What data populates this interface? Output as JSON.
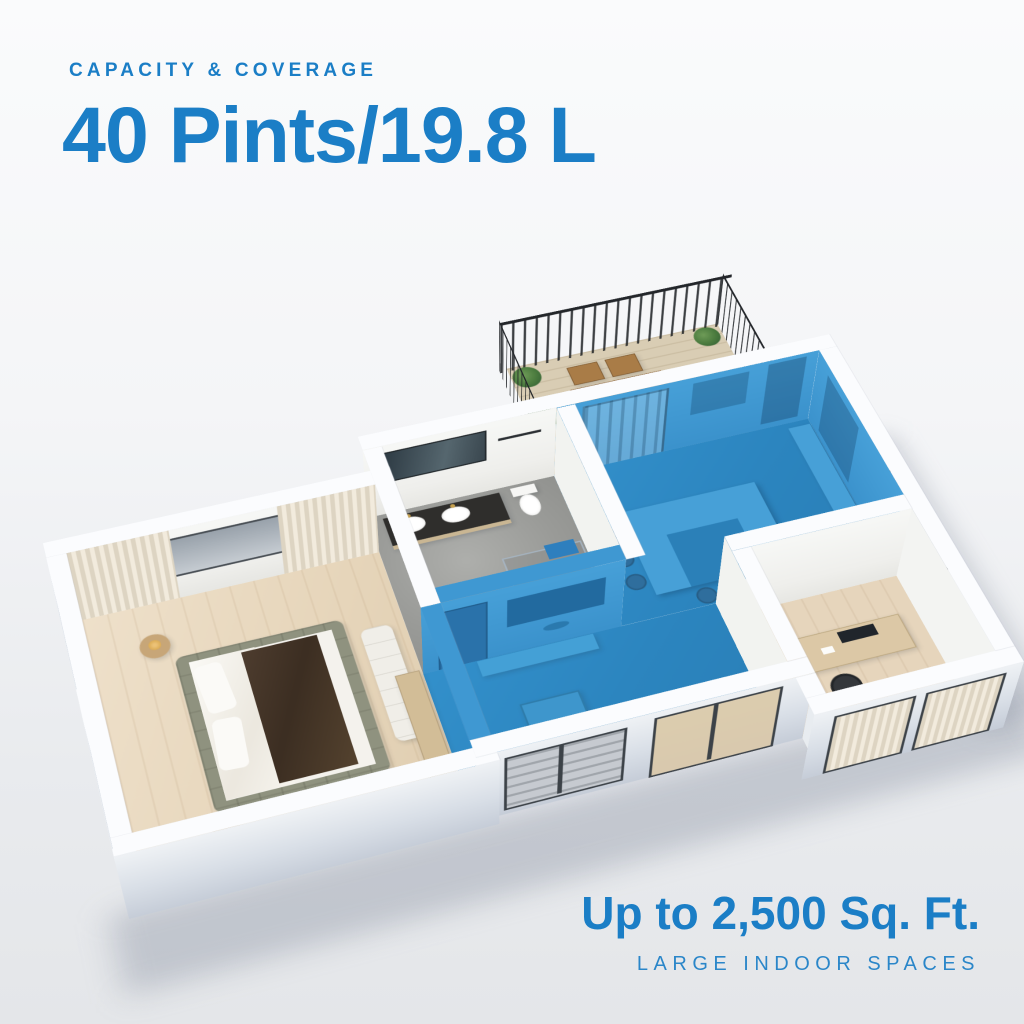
{
  "header": {
    "eyebrow": "CAPACITY & COVERAGE",
    "headline": "40 Pints/19.8 L"
  },
  "footer": {
    "coverage": "Up to 2,500 Sq. Ft.",
    "subtitle": "LARGE INDOOR SPACES"
  },
  "colors": {
    "accent": "#1b7ec6",
    "highlight_floor": "#2e8ac3",
    "highlight_wall": "#3f98d2",
    "island": "#47a0d7",
    "wall_top": "#fbfcfe",
    "background_top": "#fafbfc",
    "background_bottom": "#e4e6e9"
  },
  "floorplan": {
    "style": "3d-isometric-apartment-cutaway",
    "rooms": [
      {
        "id": "balcony",
        "highlighted": false
      },
      {
        "id": "kitchen-dining",
        "highlighted": true
      },
      {
        "id": "bathroom",
        "highlighted": false
      },
      {
        "id": "bedroom",
        "highlighted": false
      },
      {
        "id": "living-room",
        "highlighted": true
      },
      {
        "id": "office",
        "highlighted": false
      }
    ]
  }
}
